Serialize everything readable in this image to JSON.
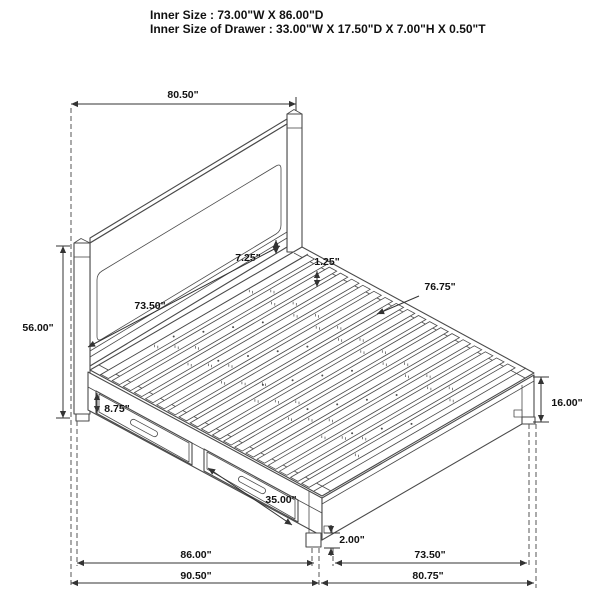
{
  "title": {
    "line1": "Inner Size : 73.00\"W X 86.00\"D",
    "line2": "Inner Size of Drawer : 33.00\"W X 17.50\"D X 7.00\"H X 0.50\"T"
  },
  "dimensions": {
    "headboard_width": "80.50\"",
    "headboard_height": "56.00\"",
    "panel_to_deck_gap": "7.25\"",
    "slat_thickness": "1.25\"",
    "slat_length": "76.75\"",
    "headboard_inner_width": "73.50\"",
    "drawer_front_height": "8.75\"",
    "drawer_width": "35.00\"",
    "platform_height": "16.00\"",
    "foot_height": "2.00\"",
    "side_inner_length": "86.00\"",
    "side_overall_length": "90.50\"",
    "foot_inner_width": "73.50\"",
    "foot_overall_width": "80.75\""
  },
  "colors": {
    "line": "#4a4a4a",
    "dimension": "#333333",
    "text": "#111111",
    "background": "#ffffff"
  }
}
